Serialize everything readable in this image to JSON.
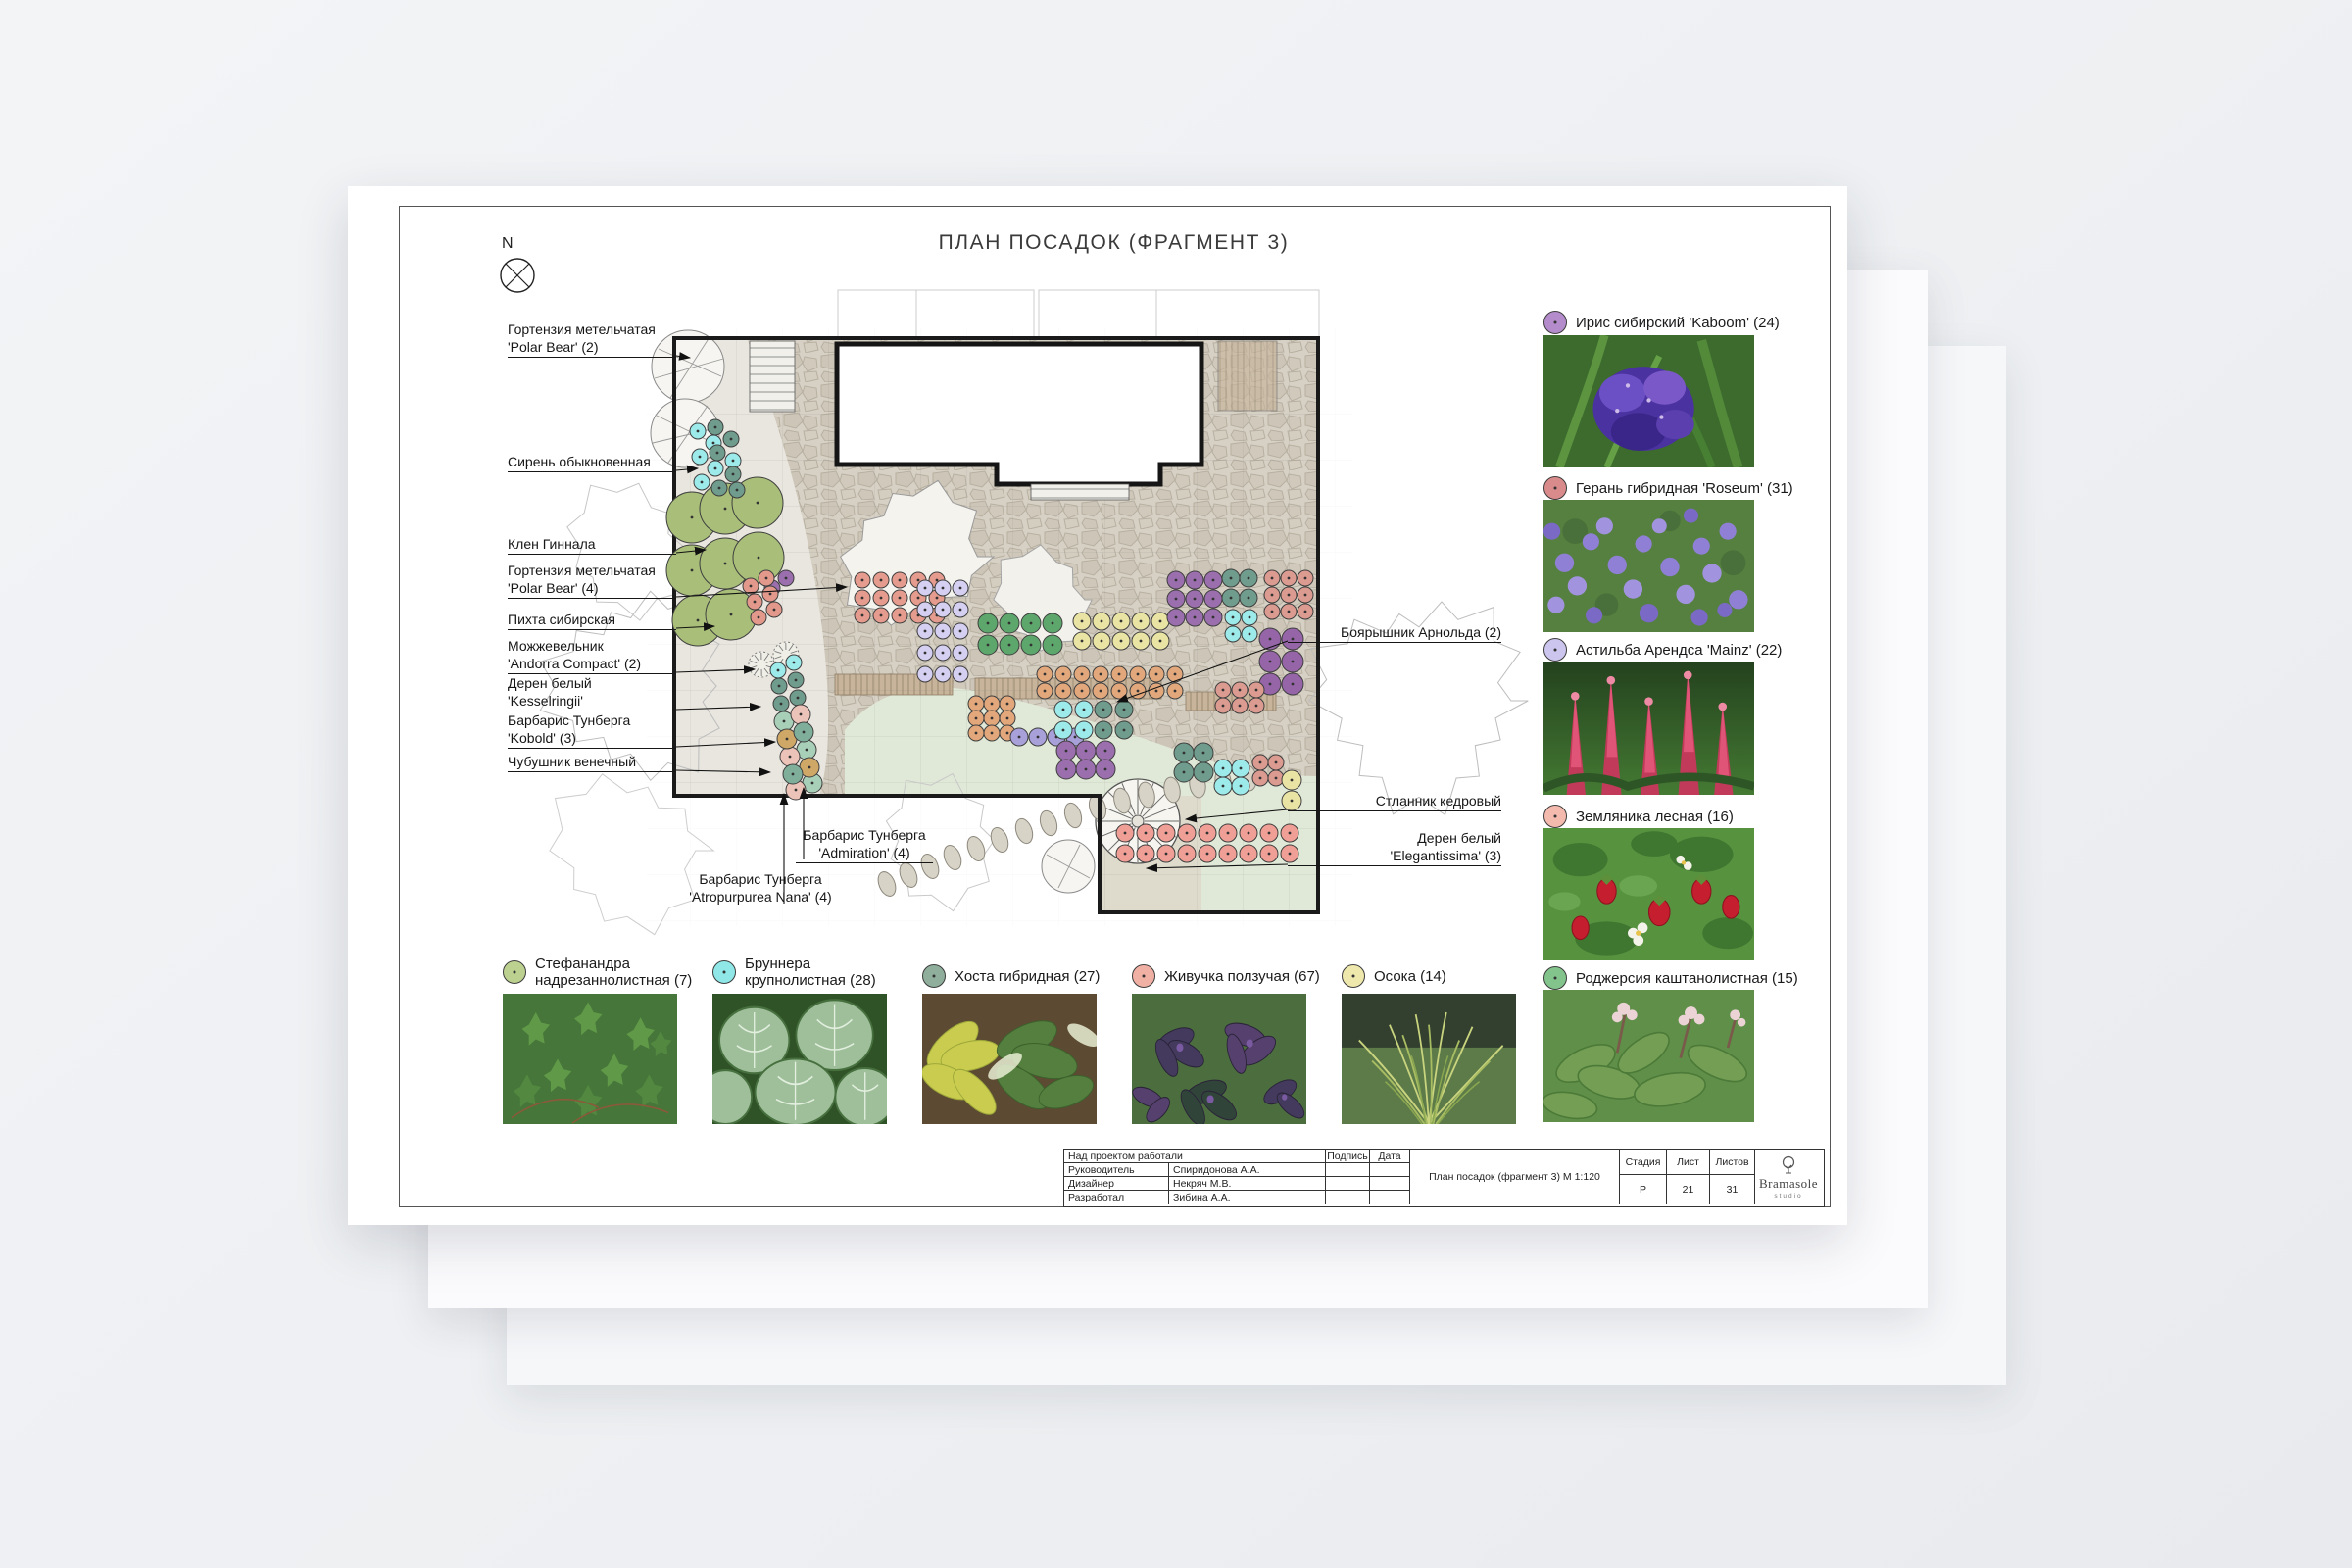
{
  "page": {
    "title": "ПЛАН ПОСАДОК (ФРАГМЕНТ 3)",
    "compass_label": "N"
  },
  "callouts": {
    "left": [
      {
        "lines": [
          "Гортензия метельчатая",
          "'Polar Bear' (2)"
        ]
      },
      {
        "lines": [
          "Сирень обыкновенная"
        ]
      },
      {
        "lines": [
          "Клен Гиннала"
        ]
      },
      {
        "lines": [
          "Гортензия метельчатая",
          "'Polar Bear' (4)"
        ]
      },
      {
        "lines": [
          "Пихта сибирская"
        ]
      },
      {
        "lines": [
          "Можжевельник",
          "'Andorra Compact' (2)"
        ]
      },
      {
        "lines": [
          "Дерен белый",
          "'Kesselringii'"
        ]
      },
      {
        "lines": [
          "Барбарис Тунберга",
          "'Kobold' (3)"
        ]
      },
      {
        "lines": [
          "Чубушник венечный"
        ]
      }
    ],
    "right": [
      {
        "lines": [
          "Боярышник Арнольда (2)"
        ]
      },
      {
        "lines": [
          "Стланник кедровый"
        ]
      },
      {
        "lines": [
          "Дерен белый",
          "'Elegantissima' (3)"
        ]
      }
    ],
    "bottom": [
      {
        "lines": [
          "Барбарис Тунберга",
          "'Admiration' (4)"
        ]
      },
      {
        "lines": [
          "Барбарис Тунберга",
          "'Atropurpurea Nana' (4)"
        ]
      }
    ]
  },
  "legend_right": [
    {
      "label": "Ирис сибирский 'Kaboom' (24)",
      "color": "#b48ccb",
      "photo": "iris"
    },
    {
      "label": "Герань гибридная 'Roseum' (31)",
      "color": "#d98a8a",
      "photo": "geranium"
    },
    {
      "label": "Астильба Арендса 'Mainz' (22)",
      "color": "#ccc6ee",
      "photo": "astilbe"
    },
    {
      "label": "Земляника лесная (16)",
      "color": "#f4baae",
      "photo": "strawberry"
    },
    {
      "label": "Роджерсия каштанолистная (15)",
      "color": "#82c48c",
      "photo": "rodgersia"
    }
  ],
  "legend_bottom": [
    {
      "lines": [
        "Стефанандра",
        "надрезаннолистная (7)"
      ],
      "color": "#bcd18f",
      "photo": "stephanandra"
    },
    {
      "lines": [
        "Бруннера",
        "крупнолистная (28)"
      ],
      "color": "#8fe7e7",
      "photo": "brunnera"
    },
    {
      "lines": [
        "Хоста гибридная (27)"
      ],
      "color": "#8fae9b",
      "photo": "hosta"
    },
    {
      "lines": [
        "Живучка ползучая (67)"
      ],
      "color": "#f0b0a4",
      "photo": "ajuga"
    },
    {
      "lines": [
        "Осока (14)"
      ],
      "color": "#efe8ad",
      "photo": "sedge"
    }
  ],
  "titleblock": {
    "header_label": "Над проектом работали",
    "sign_label": "Подпись",
    "date_label": "Дата",
    "rows": [
      [
        "Руководитель",
        "Спиридонова А.А."
      ],
      [
        "Дизайнер",
        "Некряч М.В."
      ],
      [
        "Разработал",
        "Зибина А.А."
      ]
    ],
    "doc_title": "План посадок (фрагмент 3) М 1:120",
    "stage_label": "Стадия",
    "stage": "Р",
    "sheet_label": "Лист",
    "sheet": "21",
    "sheets_label": "Листов",
    "sheets": "31",
    "logo": "Bramasole",
    "logo_sub": "studio"
  },
  "plan_symbols": [
    {
      "name": "large-shrubs",
      "color": "#a9bf79",
      "r": 26,
      "circles": [
        [
          706,
          528
        ],
        [
          740,
          519
        ],
        [
          773,
          513
        ],
        [
          706,
          582
        ],
        [
          740,
          575
        ],
        [
          774,
          569
        ],
        [
          712,
          633
        ],
        [
          746,
          627
        ]
      ]
    },
    {
      "name": "cyan-top",
      "color": "#9deaea",
      "r": 8,
      "circles": [
        [
          712,
          440
        ],
        [
          728,
          452
        ],
        [
          714,
          466
        ],
        [
          730,
          478
        ],
        [
          716,
          492
        ],
        [
          748,
          470
        ]
      ]
    },
    {
      "name": "teal-top",
      "color": "#6f9c8c",
      "r": 8,
      "circles": [
        [
          730,
          436
        ],
        [
          746,
          448
        ],
        [
          732,
          462
        ],
        [
          748,
          484
        ],
        [
          734,
          498
        ],
        [
          752,
          500
        ]
      ]
    },
    {
      "name": "purple-left",
      "color": "#9b6fad",
      "r": 8,
      "circles": [
        [
          788,
          600
        ],
        [
          802,
          590
        ]
      ]
    },
    {
      "name": "salmon-left",
      "color": "#e2998b",
      "r": 8,
      "circles": [
        [
          766,
          598
        ],
        [
          782,
          590
        ],
        [
          770,
          614
        ],
        [
          786,
          606
        ],
        [
          774,
          630
        ],
        [
          790,
          622
        ]
      ]
    },
    {
      "name": "teal-midleft",
      "color": "#6f9c8c",
      "r": 8,
      "circles": [
        [
          795,
          700
        ],
        [
          797,
          718
        ],
        [
          812,
          694
        ],
        [
          814,
          712
        ]
      ]
    },
    {
      "name": "cyan-midleft",
      "color": "#9deaea",
      "r": 8,
      "circles": [
        [
          794,
          684
        ],
        [
          810,
          676
        ]
      ]
    },
    {
      "name": "mint-bed",
      "color": "#a8cfb8",
      "r": 10,
      "circles": [
        [
          800,
          736
        ],
        [
          823,
          765
        ],
        [
          829,
          799
        ]
      ]
    },
    {
      "name": "pink-bed",
      "color": "#ecc3b8",
      "r": 10,
      "circles": [
        [
          817,
          729
        ],
        [
          806,
          772
        ],
        [
          812,
          806
        ]
      ]
    },
    {
      "name": "tan-bed",
      "color": "#cfa868",
      "r": 10,
      "circles": [
        [
          803,
          754
        ],
        [
          826,
          783
        ]
      ]
    },
    {
      "name": "tealgreen-bed",
      "color": "#7fae9b",
      "r": 10,
      "circles": [
        [
          820,
          747
        ],
        [
          809,
          790
        ]
      ]
    },
    {
      "name": "salmon-top",
      "color": "#e59c8e",
      "r": 8,
      "grid": [
        880,
        592,
        5,
        3,
        19,
        18
      ]
    },
    {
      "name": "lavender-left",
      "color": "#d5cff1",
      "r": 8,
      "grid": [
        944,
        600,
        3,
        5,
        18,
        22
      ]
    },
    {
      "name": "green-band",
      "color": "#5ea76c",
      "r": 10,
      "grid": [
        1008,
        636,
        4,
        2,
        22,
        22
      ]
    },
    {
      "name": "yellow-band",
      "color": "#e9e3a4",
      "r": 9,
      "grid": [
        1104,
        634,
        5,
        2,
        20,
        20
      ]
    },
    {
      "name": "orange-row",
      "color": "#e2a87c",
      "r": 8,
      "grid": [
        1066,
        688,
        8,
        2,
        19,
        17
      ]
    },
    {
      "name": "orange-cluster",
      "color": "#e2a87c",
      "r": 8,
      "grid": [
        996,
        718,
        3,
        3,
        16,
        15
      ]
    },
    {
      "name": "blue-row",
      "color": "#a8a0d8",
      "r": 9,
      "grid": [
        1040,
        752,
        4,
        1,
        19,
        0
      ]
    },
    {
      "name": "cyan-mid",
      "color": "#9deaea",
      "r": 9,
      "grid": [
        1085,
        724,
        2,
        2,
        21,
        21
      ]
    },
    {
      "name": "teal-mid",
      "color": "#6f9c8c",
      "r": 9,
      "grid": [
        1126,
        724,
        2,
        2,
        21,
        21
      ]
    },
    {
      "name": "purple-mid",
      "color": "#9b6fad",
      "r": 10,
      "grid": [
        1088,
        766,
        3,
        2,
        20,
        19
      ]
    },
    {
      "name": "purple-topright",
      "color": "#9b6fad",
      "r": 9,
      "grid": [
        1200,
        592,
        3,
        3,
        19,
        19
      ]
    },
    {
      "name": "teal-topright",
      "color": "#6f9c8c",
      "r": 9,
      "grid": [
        1256,
        590,
        2,
        2,
        18,
        20
      ]
    },
    {
      "name": "cyan-topright",
      "color": "#9deaea",
      "r": 8,
      "grid": [
        1258,
        630,
        2,
        2,
        17,
        17
      ]
    },
    {
      "name": "salmon-topright",
      "color": "#dc9b90",
      "r": 8,
      "grid": [
        1298,
        590,
        3,
        3,
        17,
        17
      ]
    },
    {
      "name": "purple-right",
      "color": "#9565a8",
      "r": 11,
      "grid": [
        1296,
        652,
        2,
        3,
        23,
        23
      ]
    },
    {
      "name": "salmon-rightrow",
      "color": "#dc9b90",
      "r": 8,
      "grid": [
        1248,
        704,
        3,
        2,
        17,
        16
      ]
    },
    {
      "name": "teal-bottomright",
      "color": "#6f9c8c",
      "r": 10,
      "grid": [
        1208,
        768,
        2,
        2,
        20,
        20
      ]
    },
    {
      "name": "cyan-bottomright",
      "color": "#9deaea",
      "r": 9,
      "grid": [
        1248,
        784,
        2,
        2,
        18,
        18
      ]
    },
    {
      "name": "salmon-bottomright",
      "color": "#dc9b90",
      "r": 8,
      "grid": [
        1286,
        778,
        2,
        2,
        16,
        16
      ]
    },
    {
      "name": "yellow-bottomright",
      "color": "#e9e3a4",
      "r": 10,
      "grid": [
        1318,
        796,
        1,
        2,
        0,
        21
      ]
    },
    {
      "name": "ext-salmon-rows",
      "color": "#ef9f95",
      "r": 9,
      "grid": [
        1148,
        850,
        9,
        2,
        21,
        21
      ]
    }
  ]
}
